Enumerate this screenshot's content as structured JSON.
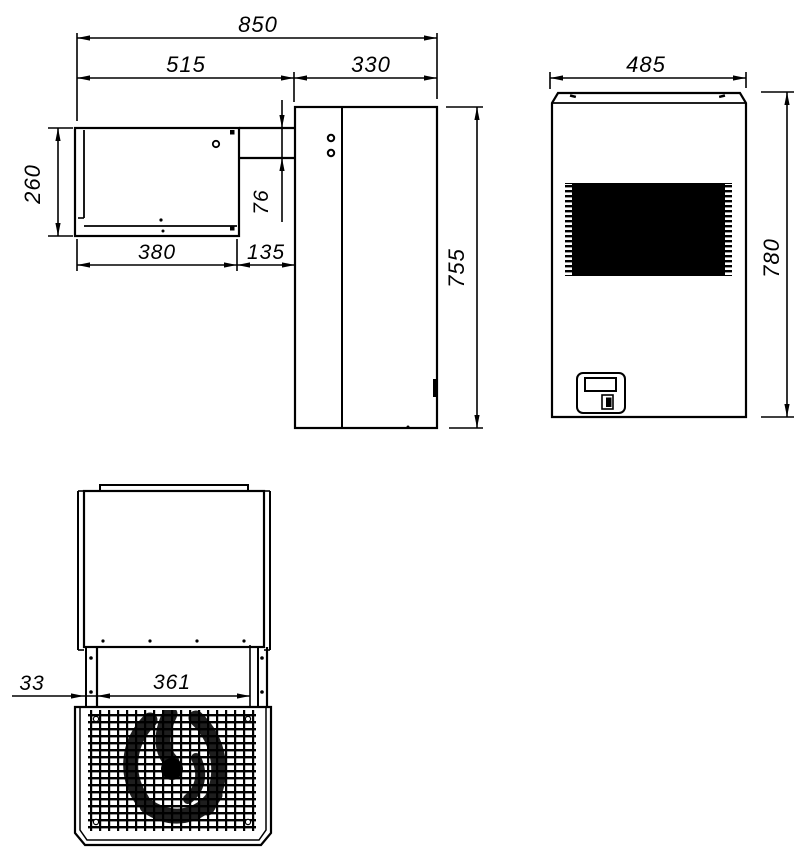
{
  "drawing": {
    "type": "technical-dimension-drawing",
    "colors": {
      "line": "#000000",
      "background": "#ffffff"
    },
    "views": [
      "side-view",
      "front-view",
      "top-view"
    ]
  },
  "dims": {
    "side_overall_length": "850",
    "side_upper_left_length": "515",
    "side_condenser_depth": "330",
    "side_evaporator_height": "260",
    "side_duct_height": "76",
    "side_evaporator_bottom_length": "380",
    "side_bottom_gap": "135",
    "side_condenser_height": "755",
    "front_width": "485",
    "front_height": "780",
    "top_rail_offset": "33",
    "top_fan_opening_width": "361"
  }
}
